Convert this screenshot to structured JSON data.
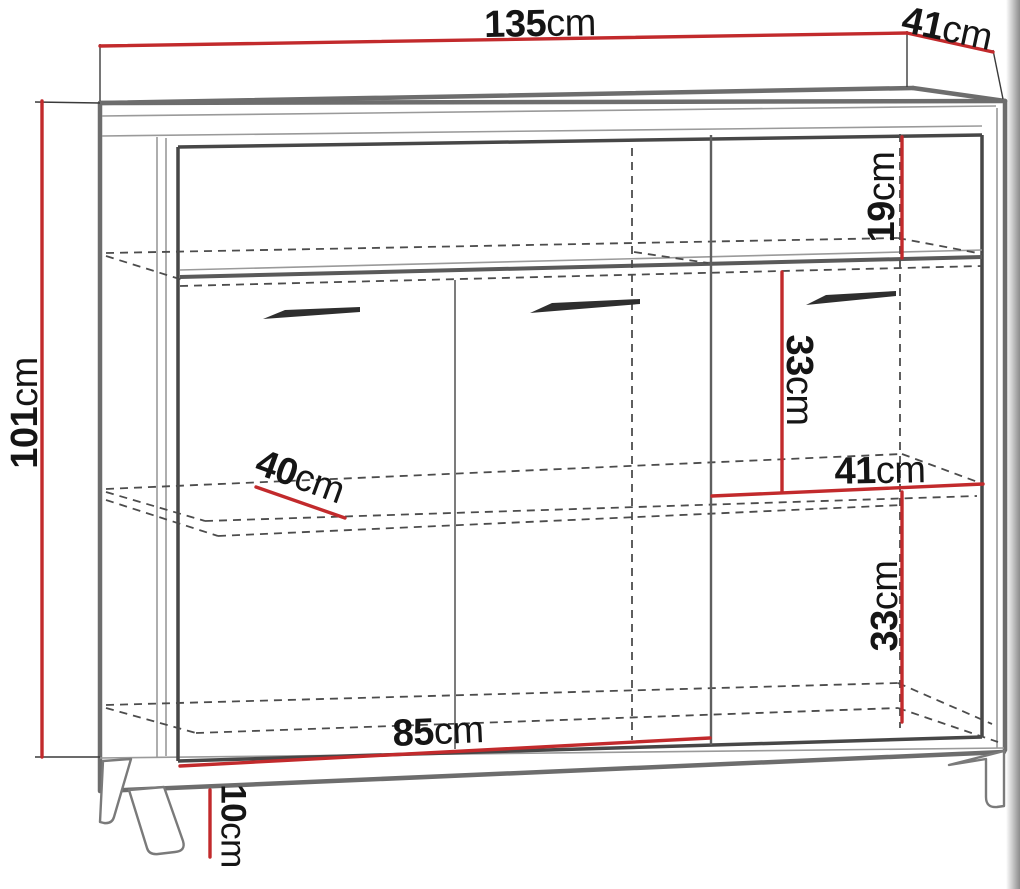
{
  "diagram": {
    "kind": "furniture-dimension-drawing",
    "subject": "sideboard-perspective-view"
  },
  "colors": {
    "dimension_line": "#c22a2c",
    "extension_line": "#3a3a3a",
    "label_text": "#151515",
    "outline_thick": "#6d6d6d",
    "outline_inner": "#474747",
    "hidden_dash": "#4c4c4c",
    "background": "#ffffff"
  },
  "dimensions": {
    "width_top": {
      "value": "135",
      "unit": "cm"
    },
    "depth_top": {
      "value": "41",
      "unit": "cm"
    },
    "height_left": {
      "value": "101",
      "unit": "cm"
    },
    "top_shelf_height": {
      "value": "19",
      "unit": "cm"
    },
    "upper_right_shelf_height": {
      "value": "33",
      "unit": "cm"
    },
    "right_compartment_width": {
      "value": "41",
      "unit": "cm"
    },
    "lower_right_shelf_height": {
      "value": "33",
      "unit": "cm"
    },
    "shelf_depth": {
      "value": "40",
      "unit": "cm"
    },
    "doors_width": {
      "value": "85",
      "unit": "cm"
    },
    "leg_height": {
      "value": "10",
      "unit": "cm"
    }
  }
}
